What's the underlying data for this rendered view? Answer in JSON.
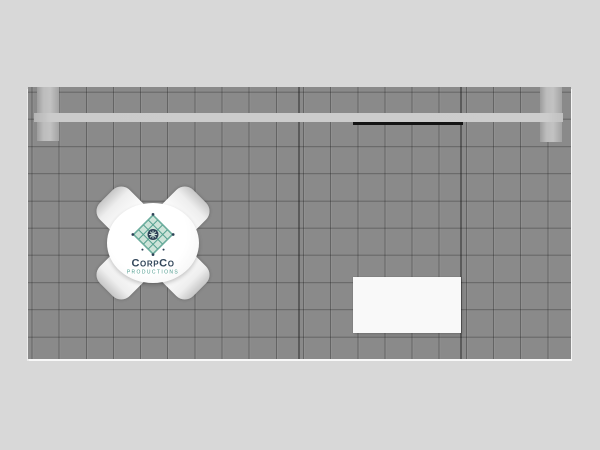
{
  "scene": {
    "description_visible_text_only": true,
    "colors": {
      "background": "#d8d8d8",
      "floor": "#8a8a8a",
      "grid_line": "#636363",
      "panel_seam": "#565656",
      "header_beam": "#cbcbcb",
      "column": "#b5b5b5",
      "monitor_edge": "#141414",
      "furniture_white": "#f9f9f9",
      "logo_name_color": "#33475b",
      "logo_tagline_color": "#4c9b8d",
      "logo_icon_fill": "#cde4d9",
      "logo_icon_stroke": "#55a190"
    }
  },
  "logo": {
    "name": "CorpCo",
    "tagline": "Productions",
    "icon": "film-grid-diamond-icon"
  },
  "elements": {
    "floor": "grid-carpet-plan-view",
    "beam": "back-wall-header-beam",
    "left_column": "left-support-column",
    "right_column": "right-support-column",
    "monitor": "wall-monitor-edge",
    "counter": "white-counter",
    "table": "round-meeting-table",
    "chairs": "four-chairs-x-arrangement"
  }
}
